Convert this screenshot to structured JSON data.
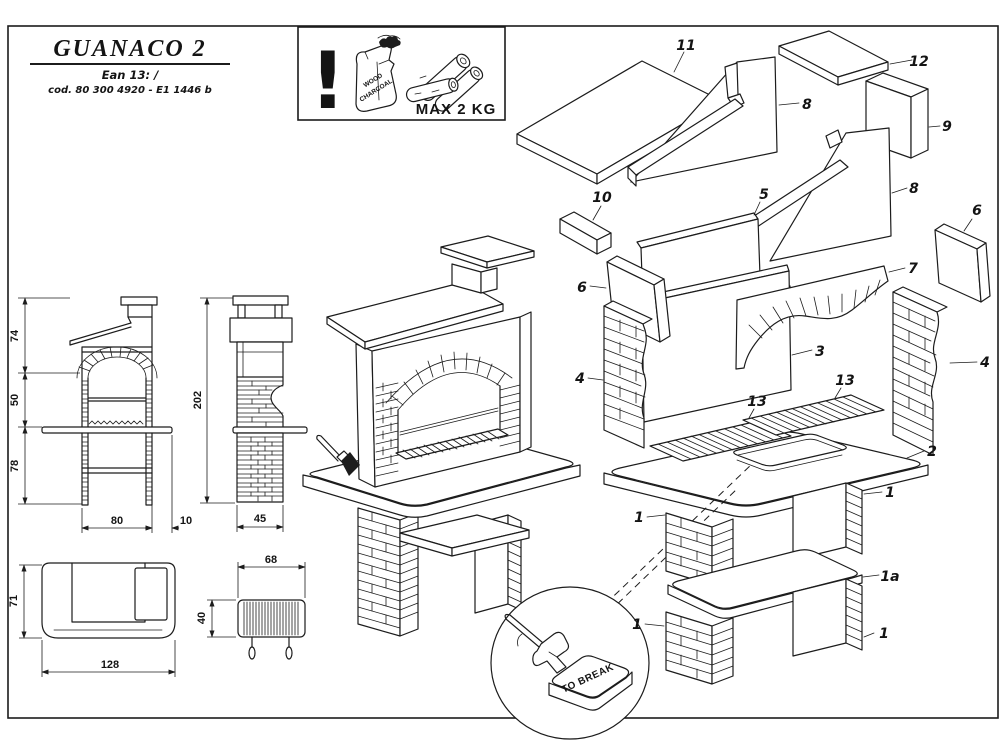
{
  "title_block": {
    "title": "GUANACO 2",
    "ean_line": "Ean 13:   /",
    "cod_line": "cod. 80 300 4920  - E1 1446 b"
  },
  "warning_box": {
    "exclamation": "!",
    "bag_line1": "WOOD",
    "bag_line2": "CHARCOAL",
    "max_load": "MAX 2 KG"
  },
  "dimensions": {
    "front_upper": "74",
    "front_firebox": "50",
    "front_legs": "78",
    "total_height": "202",
    "front_width": "80",
    "worktop_overhang": "10",
    "side_depth": "45",
    "plan_depth": "71",
    "plan_width": "128",
    "grill_width": "68",
    "grill_depth": "40"
  },
  "detail_note": {
    "to_break": "TO BREAK"
  },
  "callouts": {
    "p11": "11",
    "p12": "12",
    "p8a": "8",
    "p8b": "8",
    "p9": "9",
    "p10": "10",
    "p5": "5",
    "p6a": "6",
    "p6b": "6",
    "p7": "7",
    "p3": "3",
    "p4a": "4",
    "p4b": "4",
    "p13a": "13",
    "p13b": "13",
    "p2": "2",
    "p1tl": "1",
    "p1tr": "1",
    "p1a": "1a",
    "p1bl": "1",
    "p1br": "1"
  },
  "colors": {
    "ink": "#1c1c1c",
    "paper": "#ffffff"
  }
}
